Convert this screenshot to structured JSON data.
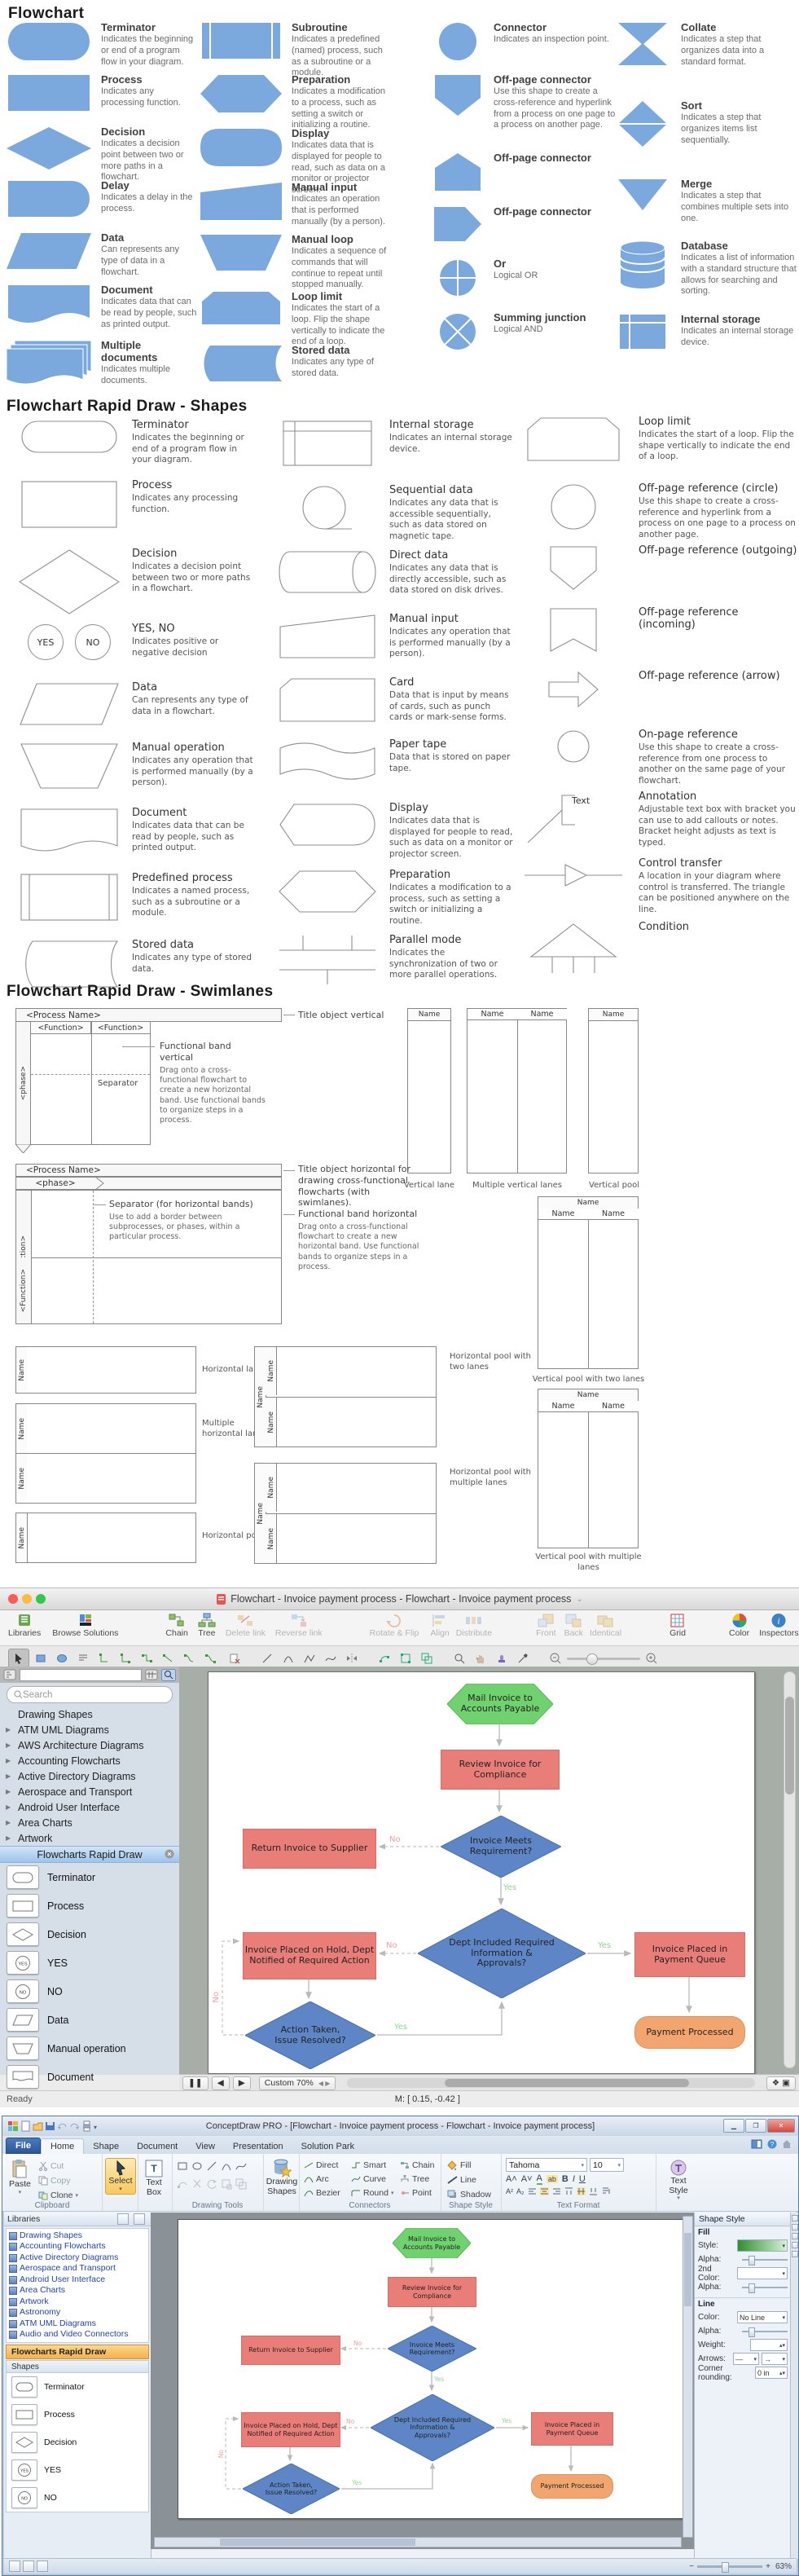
{
  "s1": {
    "title": "Flowchart",
    "c1": [
      {
        "n": "Terminator",
        "d": "Indicates the beginning or end of a program flow in your diagram."
      },
      {
        "n": "Process",
        "d": "Indicates any processing function."
      },
      {
        "n": "Decision",
        "d": "Indicates a decision point between two or more paths in a flowchart."
      },
      {
        "n": "Delay",
        "d": "Indicates a delay in the process."
      },
      {
        "n": "Data",
        "d": "Can represents any type of data in a flowchart."
      },
      {
        "n": "Document",
        "d": "Indicates data that can be read by people, such as printed output."
      },
      {
        "n": "Multiple documents",
        "d": "Indicates multiple documents."
      }
    ],
    "c2": [
      {
        "n": "Subroutine",
        "d": "Indicates a predefined (named) process, such as a subroutine or a module."
      },
      {
        "n": "Preparation",
        "d": "Indicates a modification to a process, such as setting a switch or initializing a routine."
      },
      {
        "n": "Display",
        "d": "Indicates data that is displayed for people to read, such as data on a monitor or projector screen."
      },
      {
        "n": "Manual input",
        "d": "Indicates an operation that is performed manually (by a person)."
      },
      {
        "n": "Manual loop",
        "d": "Indicates a sequence of commands that will continue to repeat until stopped manually."
      },
      {
        "n": "Loop limit",
        "d": "Indicates the start of a loop. Flip the shape vertically to indicate the end of a loop."
      },
      {
        "n": "Stored data",
        "d": "Indicates any type of stored data."
      }
    ],
    "c3": [
      {
        "n": "Connector",
        "d": "Indicates an inspection point."
      },
      {
        "n": "Off-page connector",
        "d": "Use this shape to create a cross-reference and hyperlink from a process on one page to a process on another page."
      },
      {
        "n": "Off-page connector",
        "d": ""
      },
      {
        "n": "Off-page connector",
        "d": ""
      },
      {
        "n": "Or",
        "d": "Logical OR"
      },
      {
        "n": "Summing junction",
        "d": "Logical AND"
      }
    ],
    "c4": [
      {
        "n": "Collate",
        "d": "Indicates a step that organizes data into a standard format."
      },
      {
        "n": "Sort",
        "d": "Indicates a step that organizes items list sequentially."
      },
      {
        "n": "Merge",
        "d": "Indicates a step that combines multiple sets into one."
      },
      {
        "n": "Database",
        "d": "Indicates a list of information with a standard structure that allows for searching and sorting."
      },
      {
        "n": "Internal storage",
        "d": "Indicates an internal storage device."
      }
    ]
  },
  "s2": {
    "title": "Flowchart Rapid Draw - Shapes",
    "yes": "YES",
    "no": "NO",
    "text_label": "Text",
    "c1": [
      {
        "n": "Terminator",
        "d": "Indicates the beginning or end of a program flow in your diagram."
      },
      {
        "n": "Process",
        "d": "Indicates any processing function."
      },
      {
        "n": "Decision",
        "d": "Indicates a decision point between two or more paths in a flowchart."
      },
      {
        "n": "YES, NO",
        "d": "Indicates positive or negative decision"
      },
      {
        "n": "Data",
        "d": "Can represents any type of data in a flowchart."
      },
      {
        "n": "Manual operation",
        "d": "Indicates any operation that is performed manually (by a person)."
      },
      {
        "n": "Document",
        "d": "Indicates data that can be read by people, such as printed output."
      },
      {
        "n": "Predefined process",
        "d": "Indicates a named process, such as a subroutine or a module."
      },
      {
        "n": "Stored data",
        "d": "Indicates any type of stored data."
      }
    ],
    "c2": [
      {
        "n": "Internal storage",
        "d": "Indicates an internal storage device."
      },
      {
        "n": "Sequential data",
        "d": "Indicates any data that is accessible sequentially, such as data stored on magnetic tape."
      },
      {
        "n": "Direct data",
        "d": "Indicates any data that is directly accessible, such as data stored on disk drives."
      },
      {
        "n": "Manual input",
        "d": "Indicates any operation that is performed manually (by a person)."
      },
      {
        "n": "Card",
        "d": "Data that is input by means of cards, such as punch cards or mark-sense forms."
      },
      {
        "n": "Paper tape",
        "d": "Data that is stored on paper tape."
      },
      {
        "n": "Display",
        "d": "Indicates data that is displayed for people to read, such as data on a monitor or projector screen."
      },
      {
        "n": "Preparation",
        "d": "Indicates a modification to a process, such as setting a switch or initializing a routine."
      },
      {
        "n": "Parallel mode",
        "d": "Indicates the synchronization of two or more parallel operations."
      }
    ],
    "c3": [
      {
        "n": "Loop limit",
        "d": "Indicates the start of a loop. Flip the shape vertically to indicate the end of a loop."
      },
      {
        "n": "Off-page reference (circle)",
        "d": "Use this shape to create a cross-reference and hyperlink from a process on one page to a process on another page."
      },
      {
        "n": "Off-page reference (outgoing)",
        "d": ""
      },
      {
        "n": "Off-page reference (incoming)",
        "d": ""
      },
      {
        "n": "Off-page reference (arrow)",
        "d": ""
      },
      {
        "n": "On-page reference",
        "d": "Use this shape to create a cross-reference from one process to another on the same page of your flowchart."
      },
      {
        "n": "Annotation",
        "d": "Adjustable text box with bracket you can use to add callouts or notes. Bracket height adjusts as text is typed."
      },
      {
        "n": "Control transfer",
        "d": "A location in your diagram where control is transferred. The triangle can be positioned anywhere on the line."
      },
      {
        "n": "Condition",
        "d": ""
      }
    ]
  },
  "s3": {
    "title": "Flowchart Rapid Draw - Swimlanes",
    "name": "Name",
    "process": "<Process Name>",
    "func": "<Function>",
    "phase": "<phase>",
    "separator": "Separator",
    "t_vert": "Title object vertical",
    "band_v": "Functional band vertical",
    "band_v_d": "Drag onto a cross-functional flowchart to create a new horizontal band. Use functional bands to organize steps in a process.",
    "t_horiz": "Title object horizontal for drawing cross-functional flowcharts (with swimlanes).",
    "sep_h": "Separator (for horizontal bands)",
    "sep_h_d": "Use to add a border between subprocesses, or phases, within a particular process.",
    "band_h": "Functional band horizontal",
    "band_h_d": "Drag onto a cross-functional flowchart to create a new horizontal band. Use functional bands to organize steps in a process.",
    "vl": "Vertical lane",
    "mvl": "Multiple vertical lanes",
    "vp": "Vertical pool",
    "vp2": "Vertical pool with two lanes",
    "vpm": "Vertical pool with multiple lanes",
    "hl": "Horizontal lane",
    "mhl": "Multiple horizontal lanes",
    "hp": "Horizontal pool",
    "hp2": "Horizontal pool with two lanes",
    "hpm": "Horizontal pool with multiple lanes"
  },
  "flow": {
    "n1": "Mail Invoice to Accounts Payable",
    "n2": "Review Invoice for Compliance",
    "n3": "Invoice Meets Requirement?",
    "n4": "Return Invoice to Supplier",
    "n5": "Dept Included Required Information & Approvals?",
    "n6": "Invoice Placed on Hold, Dept Notified of Required Action",
    "n7": "Invoice Placed in Payment Queue",
    "n8": "Action Taken, Issue Resolved?",
    "n9": "Payment Processed",
    "yes": "Yes",
    "no": "No",
    "colors": {
      "start": "#6fd26f",
      "task": "#e97e78",
      "decision": "#5e86c6",
      "end": "#f2a express"
    }
  },
  "mac": {
    "title": "Flowchart - Invoice payment process - Flowchart - Invoice payment process",
    "tools": [
      "Libraries",
      "Browse Solutions",
      "Chain",
      "Tree",
      "Delete link",
      "Reverse link",
      "Rotate & Flip",
      "Align",
      "Distribute",
      "Front",
      "Back",
      "Identical",
      "Grid",
      "Color",
      "Inspectors"
    ],
    "search": "Search",
    "libs": [
      "Drawing Shapes",
      "ATM UML Diagrams",
      "AWS Architecture Diagrams",
      "Accounting Flowcharts",
      "Active Directory Diagrams",
      "Aerospace and Transport",
      "Android User Interface",
      "Area Charts",
      "Artwork"
    ],
    "active": "Flowcharts Rapid Draw",
    "shapes": [
      "Terminator",
      "Process",
      "Decision",
      "YES",
      "NO",
      "Data",
      "Manual operation",
      "Document"
    ],
    "zoom": "Custom 70%",
    "coords": "M: [ 0.15, -0.42 ]",
    "ready": "Ready"
  },
  "win": {
    "title": "ConceptDraw PRO - [Flowchart - Invoice payment process - Flowchart - Invoice payment process]",
    "tabs": [
      "File",
      "Home",
      "Shape",
      "Document",
      "View",
      "Presentation",
      "Solution Park"
    ],
    "rb": {
      "paste": "Paste",
      "cut": "Cut",
      "copy": "Copy",
      "clone": "Clone",
      "g1": "Clipboard",
      "select": "Select",
      "textbox": "Text Box",
      "g2": "Drawing Tools",
      "dshapes": "Drawing Shapes",
      "direct": "Direct",
      "smart": "Smart",
      "arc": "Arc",
      "curve": "Curve",
      "bezier": "Bezier",
      "round": "Round",
      "chain": "Chain",
      "tree": "Tree",
      "point": "Point",
      "g3": "Connectors",
      "fill": "Fill",
      "line": "Line",
      "shadow": "Shadow",
      "g4": "Shape Style",
      "font": "Tahoma",
      "size": "10",
      "g5": "Text Format",
      "tstyle": "Text Style"
    },
    "libs_h": "Libraries",
    "libs": [
      "Drawing Shapes",
      "Accounting Flowcharts",
      "Active Directory Diagrams",
      "Aerospace and Transport",
      "Android User Interface",
      "Area Charts",
      "Artwork",
      "Astronomy",
      "ATM UML Diagrams",
      "Audio and Video Connectors"
    ],
    "active": "Flowcharts Rapid Draw",
    "shapes_h": "Shapes",
    "shapes": [
      "Terminator",
      "Process",
      "Decision",
      "YES",
      "NO"
    ],
    "panel": {
      "title": "Shape Style",
      "fill": "Fill",
      "style": "Style:",
      "alpha": "Alpha:",
      "c2": "2nd Color:",
      "alpha2": "Alpha:",
      "line": "Line",
      "color": "Color:",
      "noline": "No Line",
      "lalpha": "Alpha:",
      "weight": "Weight:",
      "arrows": "Arrows:",
      "corner": "Corner rounding:",
      "corner_v": "0 in"
    },
    "zoom": "63%"
  }
}
